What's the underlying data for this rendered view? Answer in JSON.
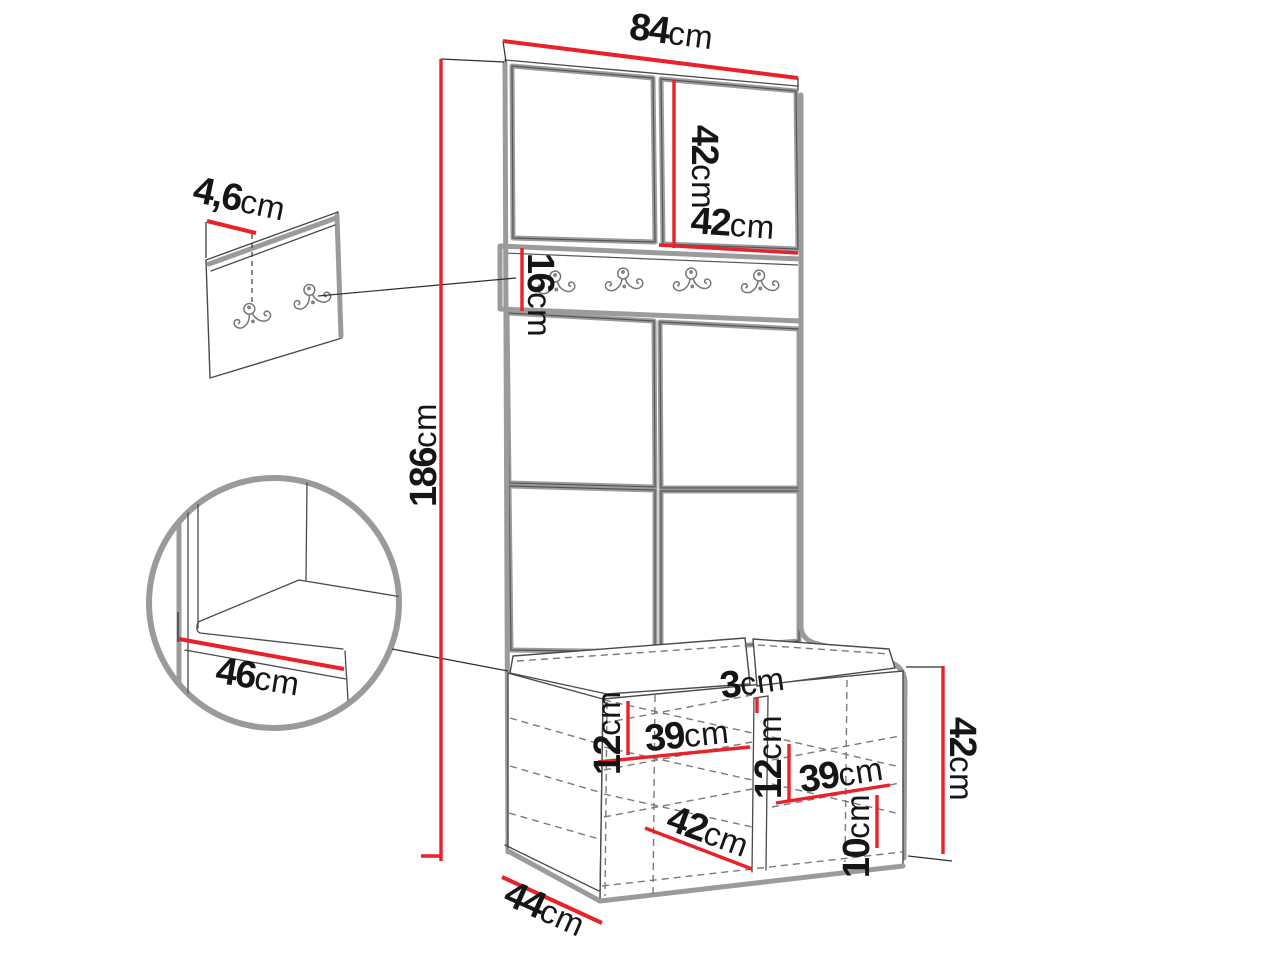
{
  "diagram": {
    "title": "hallway wardrobe with bench - dimension diagram",
    "unit": "cm",
    "colors": {
      "dimension_line": "#e8212a",
      "outline_gray": "#9b9b9b",
      "outline_dark": "#4a4a4a",
      "text": "#151515",
      "background": "#ffffff"
    },
    "labels": {
      "total_width": {
        "value": "84",
        "unit": "cm"
      },
      "top_panel_height": {
        "value": "42",
        "unit": "cm"
      },
      "top_panel_width": {
        "value": "42",
        "unit": "cm"
      },
      "hook_rail_height": {
        "value": "16",
        "unit": "cm"
      },
      "wall_panel_thickness": {
        "value": "4,6",
        "unit": "cm"
      },
      "total_height": {
        "value": "186",
        "unit": "cm"
      },
      "seat_depth_detail": {
        "value": "46",
        "unit": "cm"
      },
      "left_compartment_height": {
        "value": "12",
        "unit": "cm"
      },
      "left_compartment_width": {
        "value": "39",
        "unit": "cm"
      },
      "divider_thickness": {
        "value": "3",
        "unit": "cm"
      },
      "right_compartment_height": {
        "value": "12",
        "unit": "cm"
      },
      "right_compartment_width": {
        "value": "39",
        "unit": "cm"
      },
      "bench_inner_width": {
        "value": "42",
        "unit": "cm"
      },
      "bottom_shelf_height": {
        "value": "10",
        "unit": "cm"
      },
      "bench_height": {
        "value": "42",
        "unit": "cm"
      },
      "bench_depth": {
        "value": "44",
        "unit": "cm"
      }
    },
    "features": {
      "main_rail_hooks_count": 4,
      "wall_panel_hooks_count": 2
    }
  }
}
